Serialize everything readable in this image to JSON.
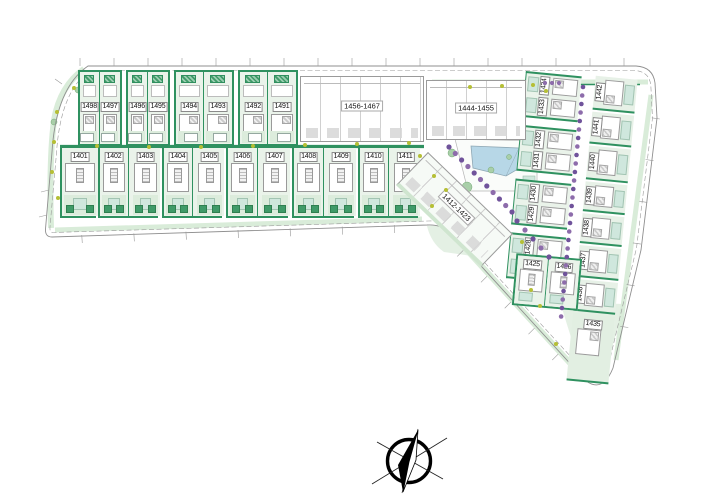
{
  "drawing": {
    "type": "residential development site plan",
    "top_row_plots": [
      "1498",
      "1497",
      "1496",
      "1495",
      "1494",
      "1493",
      "1492",
      "1491"
    ],
    "street_row_plots": [
      "1401",
      "1402",
      "1403",
      "1404",
      "1405",
      "1406",
      "1407",
      "1408",
      "1409",
      "1410",
      "1411"
    ],
    "right_inner_column_plots": [
      "1434",
      "1433",
      "1432",
      "1431",
      "1430",
      "1429",
      "1428",
      "1427"
    ],
    "right_outer_column_plots": [
      "1442",
      "1441",
      "1440",
      "1439",
      "1438",
      "1437",
      "1436",
      "1435"
    ],
    "junction_pair_plots": [
      "1425",
      "1426"
    ],
    "apartment_blocks": [
      "1456-1467",
      "1444-1455",
      "1412-1423"
    ],
    "compass": "north-arrow"
  },
  "colors": {
    "hedge_green": "#2f9160",
    "garden_green": "#eaf3ea",
    "terrace_teal": "#cfe7dd",
    "pool_blue": "#b7d7e7",
    "tree_purple": "#8d6cab",
    "shrub_yellow": "#b5bf35",
    "outline_gray": "#9a9a9a"
  }
}
